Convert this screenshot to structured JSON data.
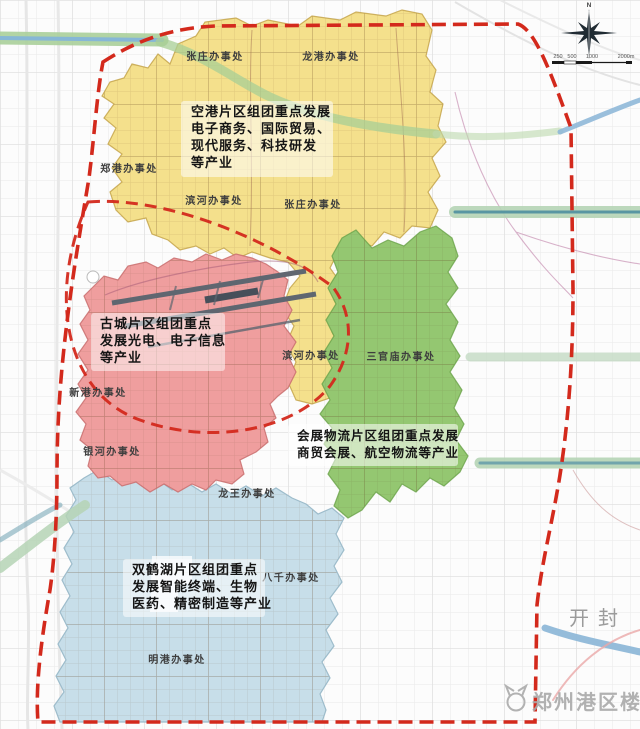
{
  "map": {
    "boundary_color": "#d3291c",
    "zones": [
      {
        "name": "空港片区",
        "color": "#f4e08c",
        "annotation": [
          "空港片区组团重点发展",
          "电子商务、国际贸易、",
          "现代服务、科技研发",
          "等产业"
        ]
      },
      {
        "name": "古城片区",
        "color": "#ef9e9e",
        "annotation": [
          "古城片区组团重点",
          "发展光电、电子信息",
          "等产业"
        ]
      },
      {
        "name": "会展物流片区",
        "color": "#94c771",
        "annotation": [
          "会展物流片区组团重点发展",
          "商贸会展、航空物流等产业"
        ]
      },
      {
        "name": "双鹤湖片区",
        "color": "#c7dee9",
        "annotation": [
          "双鹤湖片区组团重点",
          "发展智能终端、生物",
          "医药、精密制造等产业"
        ]
      }
    ],
    "offices": [
      {
        "name": "张庄办事处"
      },
      {
        "name": "龙港办事处"
      },
      {
        "name": "郑港办事处"
      },
      {
        "name": "滨河办事处"
      },
      {
        "name": "张庄办事处"
      },
      {
        "name": "滨河办事处"
      },
      {
        "name": "三官庙办事处"
      },
      {
        "name": "新港办事处"
      },
      {
        "name": "银河办事处"
      },
      {
        "name": "龙王办事处"
      },
      {
        "name": "八千办事处"
      },
      {
        "name": "明港办事处"
      }
    ],
    "neighbor_city": "开封",
    "watermark": "郑州港区楼市",
    "compass": {
      "north_label": "N"
    },
    "scale": {
      "ticks": [
        "250",
        "500",
        "1000",
        "2000m"
      ]
    }
  }
}
